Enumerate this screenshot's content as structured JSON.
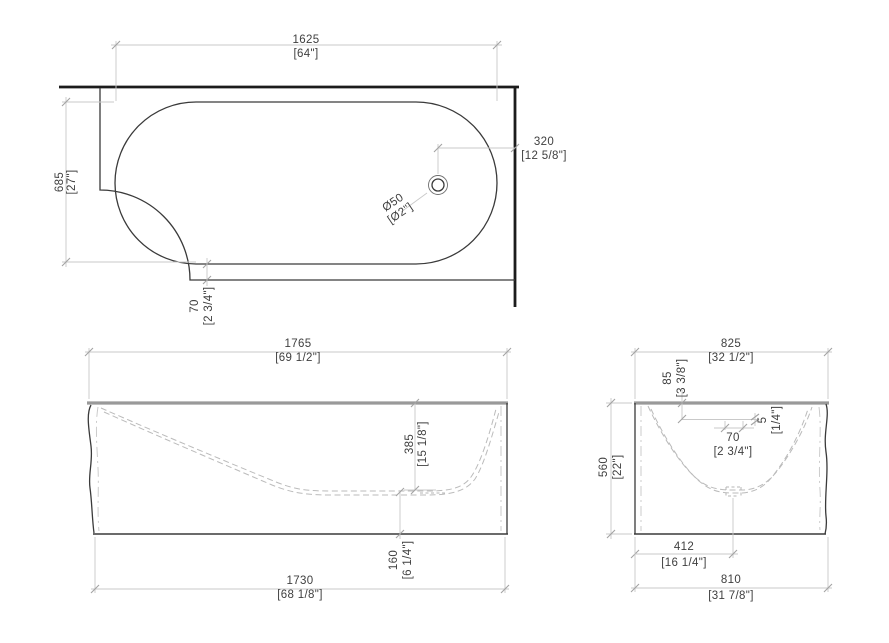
{
  "document": {
    "type": "technical-drawing",
    "subject": "corner bathtub dimension drawing",
    "units": "millimeters with inch conversions in brackets"
  },
  "colors": {
    "background": "#ffffff",
    "wall_line": "#1c1c1c",
    "outline": "#3a3a3a",
    "rim_line": "#999999",
    "hidden_line": "#bbbbbb",
    "dimension_line": "#c9c9c9",
    "dimension_text": "#3f3f3f"
  },
  "views": {
    "top": {
      "label": "top view (plan)",
      "dims": {
        "basin_length": {
          "mm": "1625",
          "in": "[64\"]"
        },
        "basin_width": {
          "mm": "685",
          "in": "[27\"]"
        },
        "drain_to_wall": {
          "mm": "320",
          "in": "[12 5/8\"]"
        },
        "rim_offset": {
          "mm": "70",
          "in": "[2 3/4\"]"
        },
        "drain_diameter": {
          "mm": "Ø50",
          "in": "[Ø2\"]"
        }
      }
    },
    "front": {
      "label": "front elevation",
      "dims": {
        "overall_length": {
          "mm": "1765",
          "in": "[69 1/2\"]"
        },
        "inner_depth": {
          "mm": "385",
          "in": "[15 1/8\"]"
        },
        "bottom_height": {
          "mm": "160",
          "in": "[6 1/4\"]"
        },
        "base_length": {
          "mm": "1730",
          "in": "[68 1/8\"]"
        }
      }
    },
    "side": {
      "label": "side elevation",
      "dims": {
        "overall_width": {
          "mm": "825",
          "in": "[32 1/2\"]"
        },
        "overflow_drop": {
          "mm": "85",
          "in": "[3 3/8\"]"
        },
        "overflow_slot_height": {
          "mm": "5",
          "in": "[1/4\"]"
        },
        "overflow_slot_width": {
          "mm": "70",
          "in": "[2 3/4\"]"
        },
        "overall_height": {
          "mm": "560",
          "in": "[22\"]"
        },
        "drain_center_offset": {
          "mm": "412",
          "in": "[16 1/4\"]"
        },
        "base_width": {
          "mm": "810",
          "in": "[31 7/8\"]"
        }
      }
    }
  }
}
